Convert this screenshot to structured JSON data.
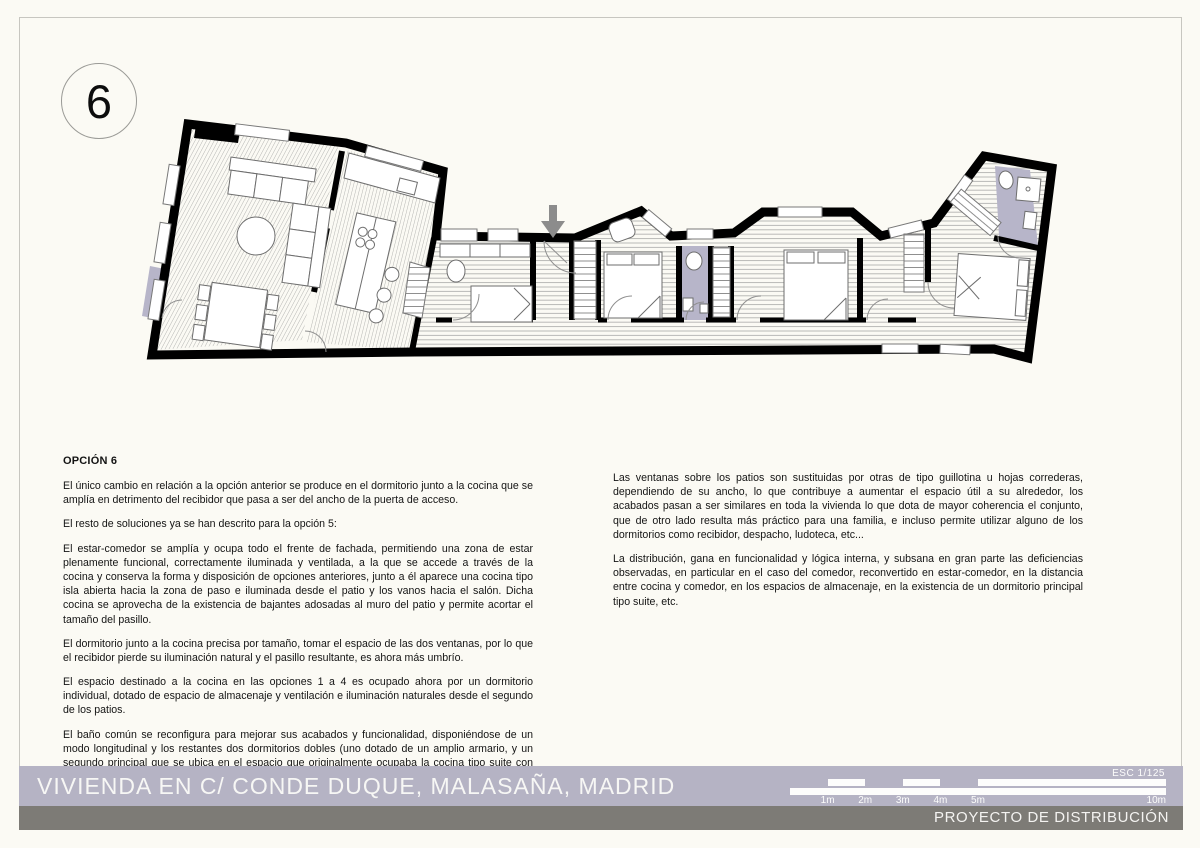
{
  "page": {
    "background": "#fbfaf4",
    "frame_color": "#c7c6c0"
  },
  "option_badge": {
    "number": "6"
  },
  "notes": {
    "heading": "OPCIÓN 6",
    "left": [
      "El único cambio en relación a la opción anterior se produce en el dormitorio junto a la cocina que se amplía en detrimento del recibidor que pasa a ser del ancho de la puerta de acceso.",
      "El resto de soluciones ya se han descrito para la opción 5:",
      "El estar-comedor se amplía y ocupa todo el frente de fachada, permitiendo una zona de estar plenamente funcional, correctamente iluminada y ventilada, a la que se accede a través de la cocina y conserva la forma y disposición de opciones anteriores, junto a él aparece una cocina tipo isla abierta hacia la zona de paso e iluminada desde el patio y los vanos hacia el salón. Dicha cocina se aprovecha de la existencia de bajantes adosadas al muro del patio y permite acortar el tamaño del pasillo.",
      "El dormitorio junto a la cocina precisa por tamaño, tomar el espacio de las dos ventanas, por lo que el recibidor pierde su iluminación natural y el pasillo resultante, es ahora más umbrío.",
      "El espacio destinado a la cocina en las opciones 1 a 4 es ocupado ahora por un dormitorio individual, dotado de espacio de almacenaje y ventilación e iluminación naturales desde el segundo de los patios.",
      "El baño común se reconfigura para mejorar sus acabados y funcionalidad, disponiéndose de un modo longitudinal y los restantes dos dormitorios dobles (uno dotado de un amplio armario, y un segundo principal que se ubica en el espacio que originalmente ocupaba la cocina tipo suite con baño y vestidor privativos), junto con el pasillo adosado al muro medianero, son idénticos a los de la opción anterior."
    ],
    "right": [
      "Las ventanas sobre los patios son sustituidas por otras de tipo guillotina u hojas correderas, dependiendo de su ancho, lo que contribuye a aumentar el espacio útil a su alrededor, los acabados pasan a ser similares en toda la vivienda lo que dota de mayor coherencia el conjunto, que de otro lado resulta más práctico para una familia, e incluso permite utilizar alguno de los dormitorios como recibidor, despacho, ludoteca, etc...",
      "La distribución, gana en funcionalidad y lógica interna, y subsana en gran parte las deficiencias observadas, en particular en el caso del comedor, reconvertido en estar-comedor, en la distancia entre cocina y comedor, en los espacios de almacenaje, en la existencia de un dormitorio principal tipo suite, etc."
    ]
  },
  "footer": {
    "title": "VIVIENDA EN C/ CONDE DUQUE, MALASAÑA, MADRID",
    "subtitle": "PROYECTO DE DISTRIBUCIÓN",
    "bar_color": "#b5b3c4",
    "dark_bar_color": "#7d7b76",
    "scale": {
      "label": "ESC  1/125",
      "tick_labels": [
        "1m",
        "2m",
        "3m",
        "4m",
        "5m",
        "10m"
      ]
    }
  },
  "plan": {
    "accent_color": "#b7b5c9",
    "wall_color": "#000000",
    "hatch_color": "#aeaeac",
    "entry_arrow_color": "#8c8c8c",
    "entry_arrow_direction": "down"
  }
}
